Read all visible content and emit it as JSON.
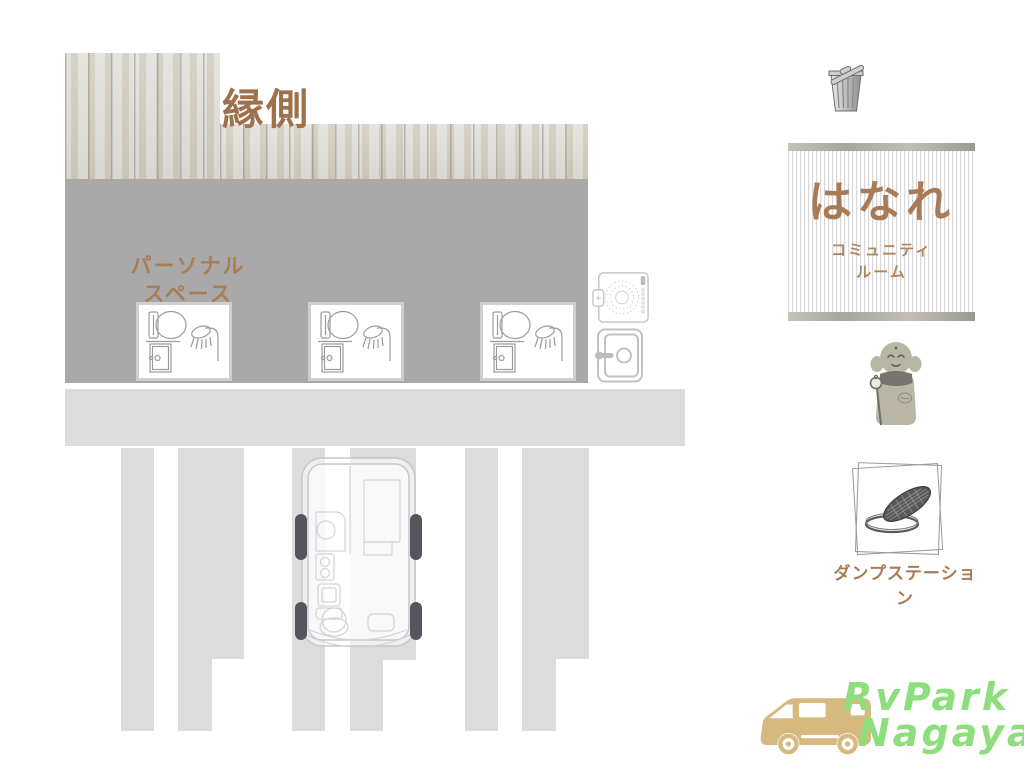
{
  "map": {
    "engawa_label": "縁側",
    "personal_space": {
      "line1": "パーソナル",
      "line2": "スペース"
    }
  },
  "sign": {
    "title": "はなれ",
    "subtitle_line1": "コミュニティ",
    "subtitle_line2": "ルーム"
  },
  "dump_station": {
    "label": "ダンプステーション"
  },
  "logo": {
    "line1": "RvPark",
    "line2": "Nagaya"
  },
  "icons": {
    "trash": "trash-can-icon",
    "washer": "washing-machine-icon",
    "door": "door-icon",
    "bath_unit": "toilet-shower-unit-icon",
    "statue": "jizo-statue-icon",
    "dump": "manhole-drain-icon",
    "rv_top": "rv-top-view-icon",
    "logo_van": "camper-van-icon"
  },
  "colors": {
    "building_gray": "#a9a9a9",
    "pavement_gray": "#dcdcdc",
    "wood_base": "#d7d4cd",
    "text_brown": "#a1764f",
    "sign_text_brown": "#a87a56",
    "sign_bar_gray": "#aaa79e",
    "logo_green": "#8ede7e",
    "van_tan": "#d6b97e",
    "wheel_dark": "#55565c"
  }
}
